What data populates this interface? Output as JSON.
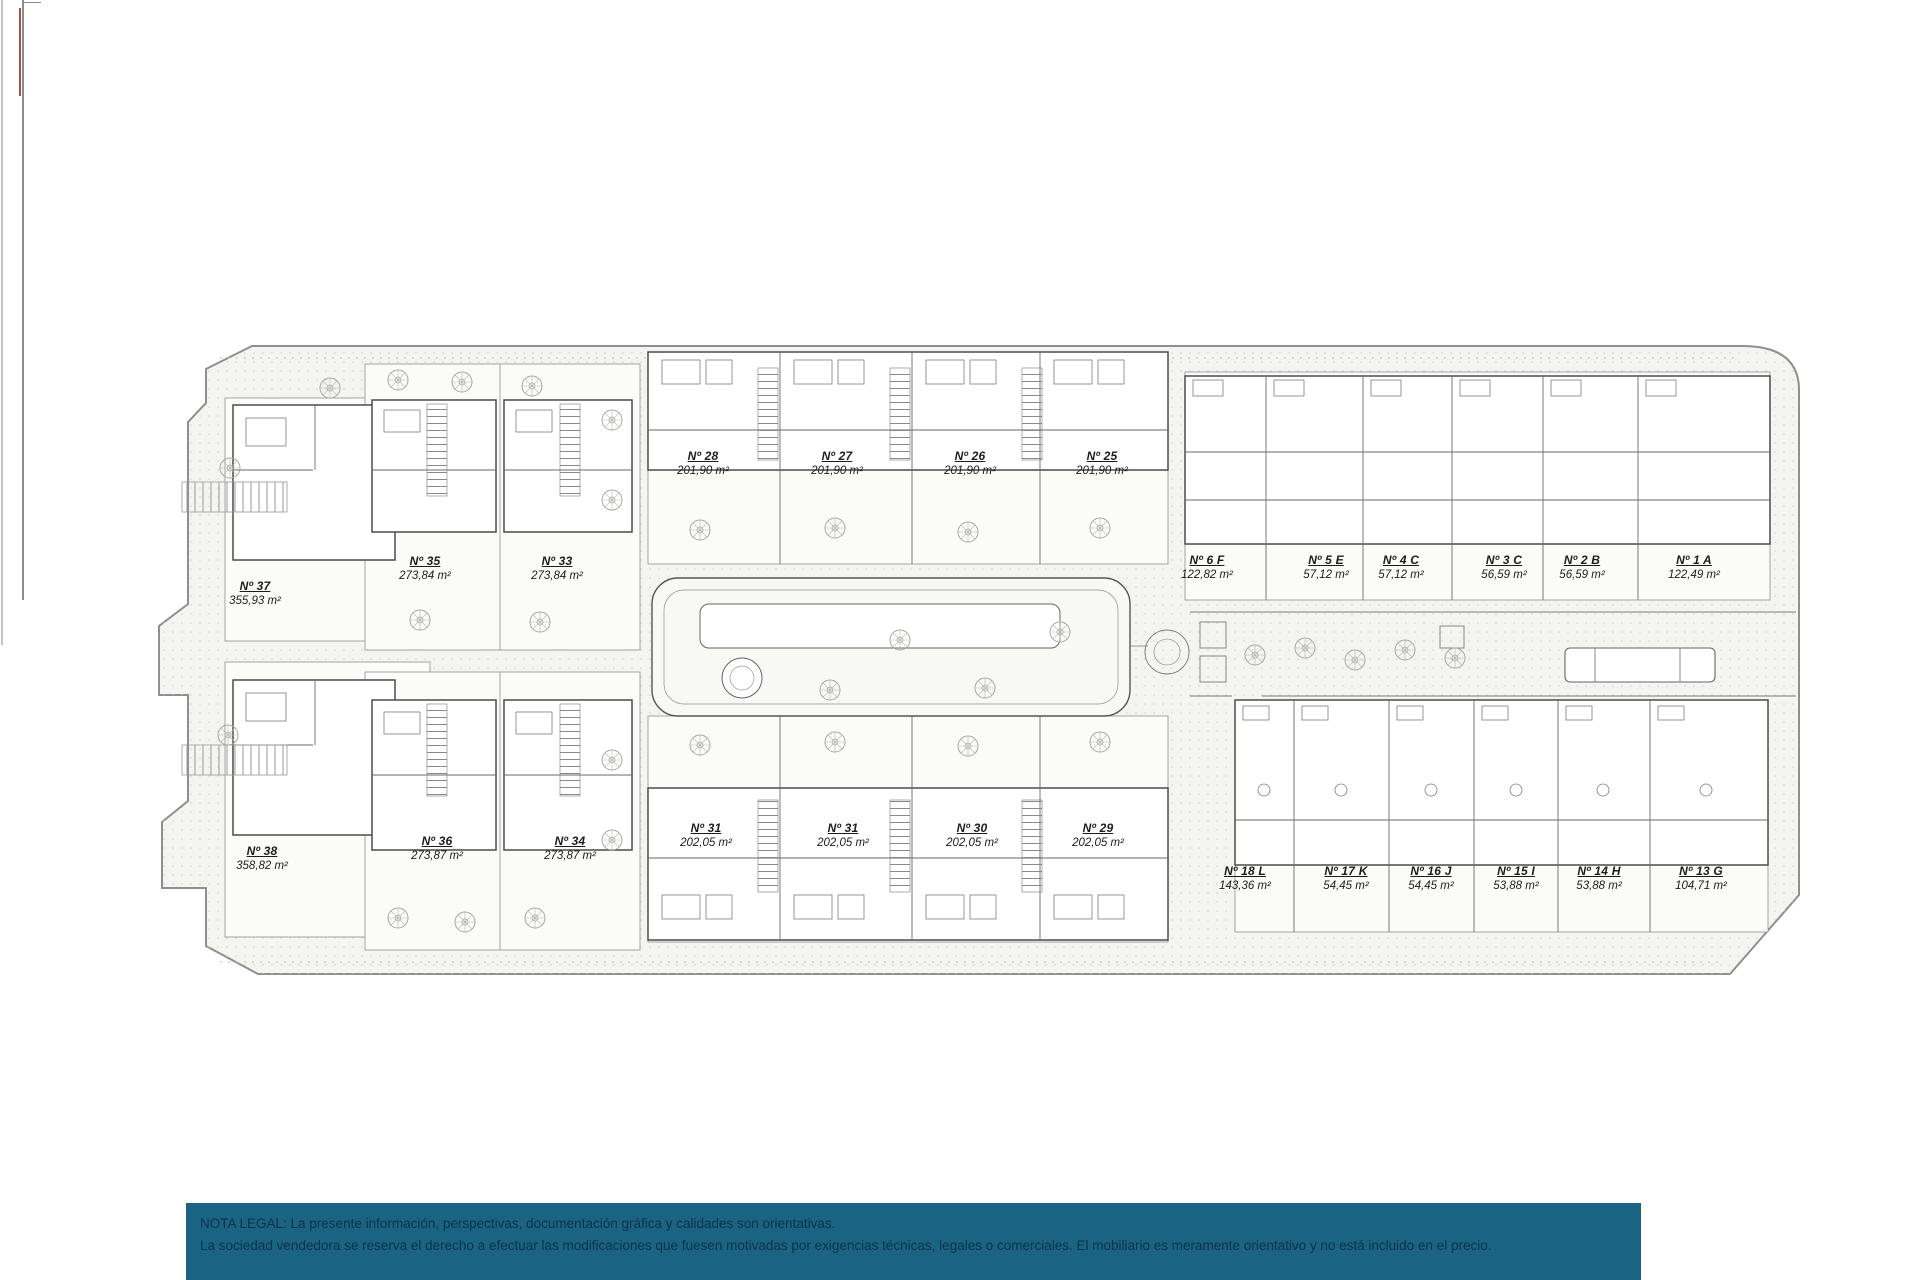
{
  "plan": {
    "units": [
      {
        "label": "Nº 37",
        "area": "355,93 m²",
        "x": 255,
        "y": 588
      },
      {
        "label": "Nº 35",
        "area": "273,84 m²",
        "x": 425,
        "y": 563
      },
      {
        "label": "Nº 33",
        "area": "273,84 m²",
        "x": 557,
        "y": 563
      },
      {
        "label": "Nº 28",
        "area": "201,90 m²",
        "x": 703,
        "y": 458
      },
      {
        "label": "Nº 27",
        "area": "201,90 m²",
        "x": 837,
        "y": 458
      },
      {
        "label": "Nº 26",
        "area": "201,90 m²",
        "x": 970,
        "y": 458
      },
      {
        "label": "Nº 25",
        "area": "201,90 m²",
        "x": 1102,
        "y": 458
      },
      {
        "label": "Nº 6 F",
        "area": "122,82 m²",
        "x": 1207,
        "y": 562
      },
      {
        "label": "Nº 5 E",
        "area": "57,12 m²",
        "x": 1326,
        "y": 562
      },
      {
        "label": "Nº 4 C",
        "area": "57,12 m²",
        "x": 1401,
        "y": 562
      },
      {
        "label": "Nº 3 C",
        "area": "56,59 m²",
        "x": 1504,
        "y": 562
      },
      {
        "label": "Nº 2 B",
        "area": "56,59 m²",
        "x": 1582,
        "y": 562
      },
      {
        "label": "Nº 1 A",
        "area": "122,49 m²",
        "x": 1694,
        "y": 562
      },
      {
        "label": "Nº 38",
        "area": "358,82 m²",
        "x": 262,
        "y": 853
      },
      {
        "label": "Nº 36",
        "area": "273,87 m²",
        "x": 437,
        "y": 843
      },
      {
        "label": "Nº 34",
        "area": "273,87 m²",
        "x": 570,
        "y": 843
      },
      {
        "label": "Nº 31",
        "area": "202,05 m²",
        "x": 706,
        "y": 830
      },
      {
        "label": "Nº 31",
        "area": "202,05 m²",
        "x": 843,
        "y": 830
      },
      {
        "label": "Nº 30",
        "area": "202,05 m²",
        "x": 972,
        "y": 830
      },
      {
        "label": "Nº 29",
        "area": "202,05 m²",
        "x": 1098,
        "y": 830
      },
      {
        "label": "Nº 18 L",
        "area": "143,36 m²",
        "x": 1245,
        "y": 873
      },
      {
        "label": "Nº 17 K",
        "area": "54,45 m²",
        "x": 1346,
        "y": 873
      },
      {
        "label": "Nº 16 J",
        "area": "54,45 m²",
        "x": 1431,
        "y": 873
      },
      {
        "label": "Nº 15 I",
        "area": "53,88 m²",
        "x": 1516,
        "y": 873
      },
      {
        "label": "Nº 14 H",
        "area": "53,88 m²",
        "x": 1599,
        "y": 873
      },
      {
        "label": "Nº 13 G",
        "area": "104,71 m²",
        "x": 1701,
        "y": 873
      }
    ]
  },
  "legal": {
    "line1": "NOTA LEGAL: La presente información, perspectivas, documentación gráfica y calidades son orientativas.",
    "line2": "La sociedad vendedora se reserva el derecho a efectuar las modificaciones que fuesen motivadas por exigencias técnicas, legales o comerciales. El mobiliario es meramente orientativo y no está incluido en el precio."
  },
  "colors": {
    "footer_bg": "#1b6383",
    "footer_text": "#0d3348",
    "red_artifact": "#a0524d",
    "plan_outline": "#8f8f8f",
    "building_line": "#4b4b4b"
  }
}
